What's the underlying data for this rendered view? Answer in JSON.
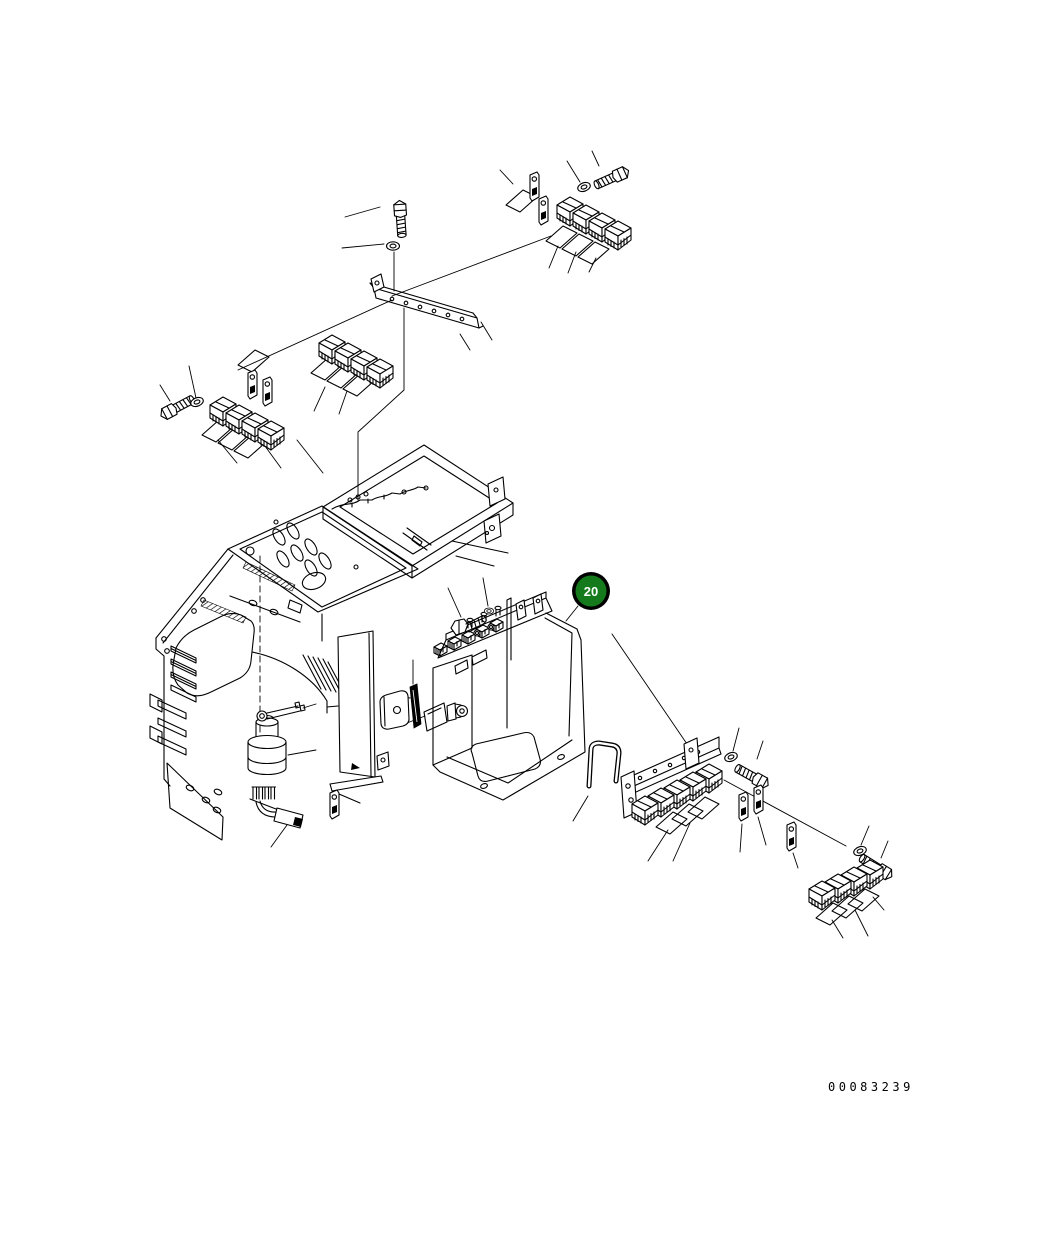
{
  "page": {
    "background": "#ffffff",
    "ink": "#000000"
  },
  "callout": {
    "label": "20",
    "fill": "#147a1c",
    "ring": "#000000",
    "text_color": "#ffffff"
  },
  "footer": {
    "part_number": "00083239"
  }
}
